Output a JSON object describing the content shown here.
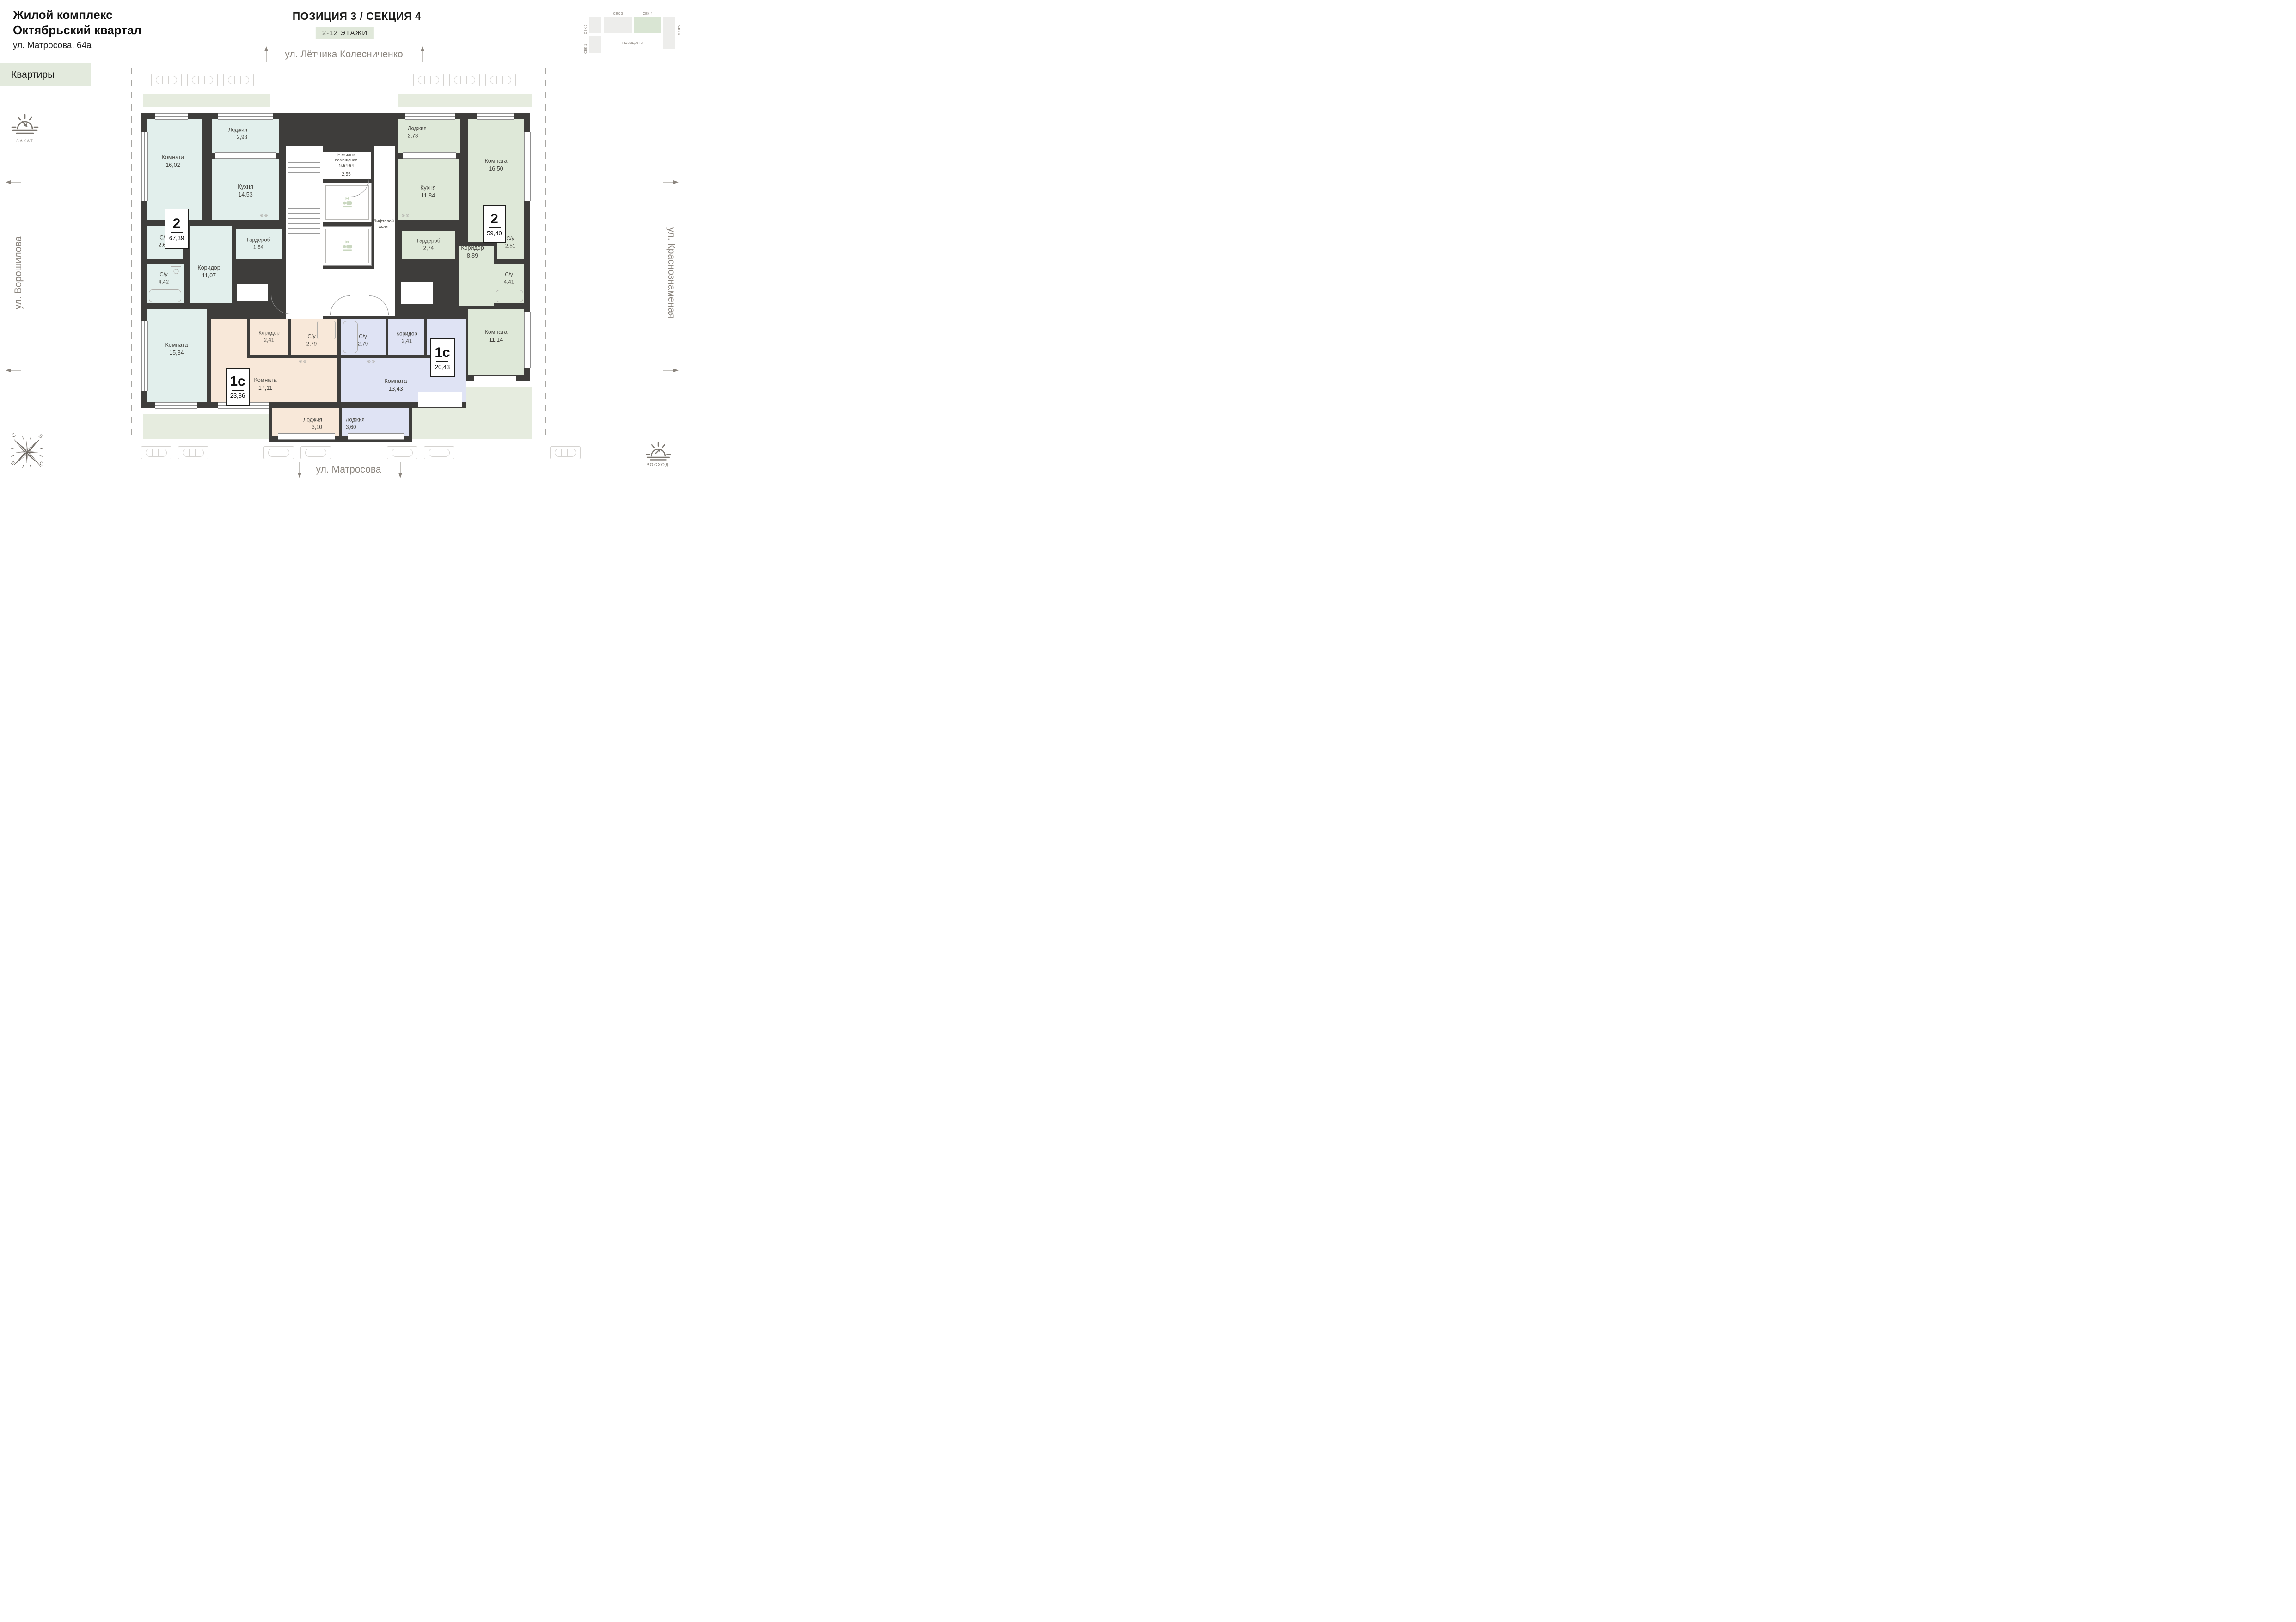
{
  "header": {
    "title1": "Жилой комплекс",
    "title2": "Октябрьский квартал",
    "address": "ул. Матросова, 64а"
  },
  "nav": {
    "apartments_label": "Квартиры"
  },
  "plan_header": {
    "title": "ПОЗИЦИЯ 3 / СЕКЦИЯ 4",
    "floors_badge": "2-12 ЭТАЖИ"
  },
  "minimap": {
    "sec1": "СЕК 1",
    "sec2": "СЕК 2",
    "sec3": "СЕК 3",
    "sec4": "СЕК 4",
    "sec5": "СЕК 5",
    "position": "ПОЗИЦИЯ 3"
  },
  "streets": {
    "top": "ул. Лётчика Колесниченко",
    "left": "ул. Ворошилова",
    "right": "ул. Краснознаменая",
    "bottom": "ул. Матросова"
  },
  "sun": {
    "sunset": "ЗАКАТ",
    "sunrise": "ВОСХОД"
  },
  "compass": {
    "n": "С",
    "e": "В",
    "w": "З",
    "s": "Ю"
  },
  "core": {
    "nonres_line1": "Нежилое",
    "nonres_line2": "помещение",
    "nonres_line3": "№54-64",
    "nonres_area": "2,55",
    "lift_hall_line1": "Лифтовой",
    "lift_hall_line2": "холл"
  },
  "apartments": [
    {
      "id": "2-left",
      "type": "2",
      "area": "67,39",
      "rooms": [
        {
          "name": "Комната",
          "area": "16,02"
        },
        {
          "name": "Кухня",
          "area": "14,53"
        },
        {
          "name": "Лоджия",
          "area": "2,98"
        },
        {
          "name": "С/у",
          "area": "2,68"
        },
        {
          "name": "С/у",
          "area": "4,42"
        },
        {
          "name": "Коридор",
          "area": "11,07"
        },
        {
          "name": "Гардероб",
          "area": "1,84"
        },
        {
          "name": "Комната",
          "area": "15,34"
        }
      ]
    },
    {
      "id": "2-right",
      "type": "2",
      "area": "59,40",
      "rooms": [
        {
          "name": "Лоджия",
          "area": "2,73"
        },
        {
          "name": "Кухня",
          "area": "11,84"
        },
        {
          "name": "Комната",
          "area": "16,50"
        },
        {
          "name": "Гардероб",
          "area": "2,74"
        },
        {
          "name": "Коридор",
          "area": "8,89"
        },
        {
          "name": "С/у",
          "area": "2,51"
        },
        {
          "name": "С/у",
          "area": "4,41"
        },
        {
          "name": "Комната",
          "area": "11,14"
        }
      ]
    },
    {
      "id": "1c-left",
      "type": "1с",
      "area": "23,86",
      "rooms": [
        {
          "name": "Коридор",
          "area": "2,41"
        },
        {
          "name": "С/у",
          "area": "2,79"
        },
        {
          "name": "Комната",
          "area": "17,11"
        },
        {
          "name": "Лоджия",
          "area": "3,10"
        }
      ]
    },
    {
      "id": "1c-right",
      "type": "1с",
      "area": "20,43",
      "rooms": [
        {
          "name": "С/у",
          "area": "2,79"
        },
        {
          "name": "Коридор",
          "area": "2,41"
        },
        {
          "name": "Комната",
          "area": "13,43"
        },
        {
          "name": "Лоджия",
          "area": "3,60"
        }
      ]
    }
  ]
}
